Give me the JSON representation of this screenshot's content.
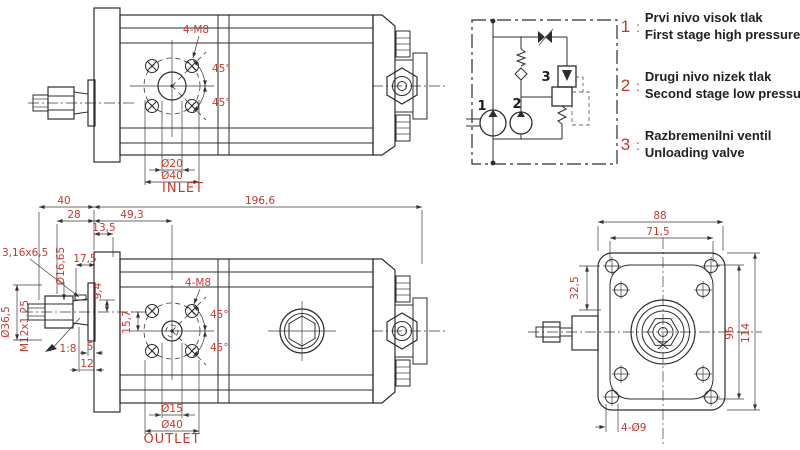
{
  "colors": {
    "dimension_red": "#c23a2e",
    "line": "#2d2d2d",
    "background": "#ffffff"
  },
  "top_view": {
    "bolt_label": "4-M8",
    "angle": "45°",
    "dia_inner": "Ø20",
    "dia_outer": "Ø40",
    "port": "INLET"
  },
  "schematic": {
    "pump1": "1",
    "pump2": "2",
    "valve": "3",
    "sep": ":",
    "legend": [
      {
        "num": "1",
        "line1": "Prvi nivo visok tlak",
        "line2": "First stage high pressure"
      },
      {
        "num": "2",
        "line1": "Drugi nivo nizek tlak",
        "line2": "Second stage low pressure"
      },
      {
        "num": "3",
        "line1": "Razbremenilni ventil",
        "line2": "Unloading valve"
      }
    ]
  },
  "bottom_view": {
    "len_total": "196,6",
    "len_40": "40",
    "len_28": "28",
    "len_49_3": "49,3",
    "len_13_5": "13,5",
    "key": "3,16x6,5",
    "dia_16_65": "Ø16,65",
    "len_17_5": "17,5",
    "len_9_4": "9,4",
    "dia_36_5": "Ø36,5",
    "thread": "M12x1,25",
    "taper": "1:8",
    "len_5": "5",
    "len_12": "12",
    "offset_15_7": "15,7",
    "bolt_label": "4-M8",
    "angle": "45°",
    "dia_inner": "Ø15",
    "dia_outer": "Ø40",
    "port": "OUTLET"
  },
  "front_view": {
    "w_88": "88",
    "w_71_5": "71,5",
    "h_32_5": "32,5",
    "h_96": "96",
    "h_114": "114",
    "holes": "4-Ø9"
  }
}
